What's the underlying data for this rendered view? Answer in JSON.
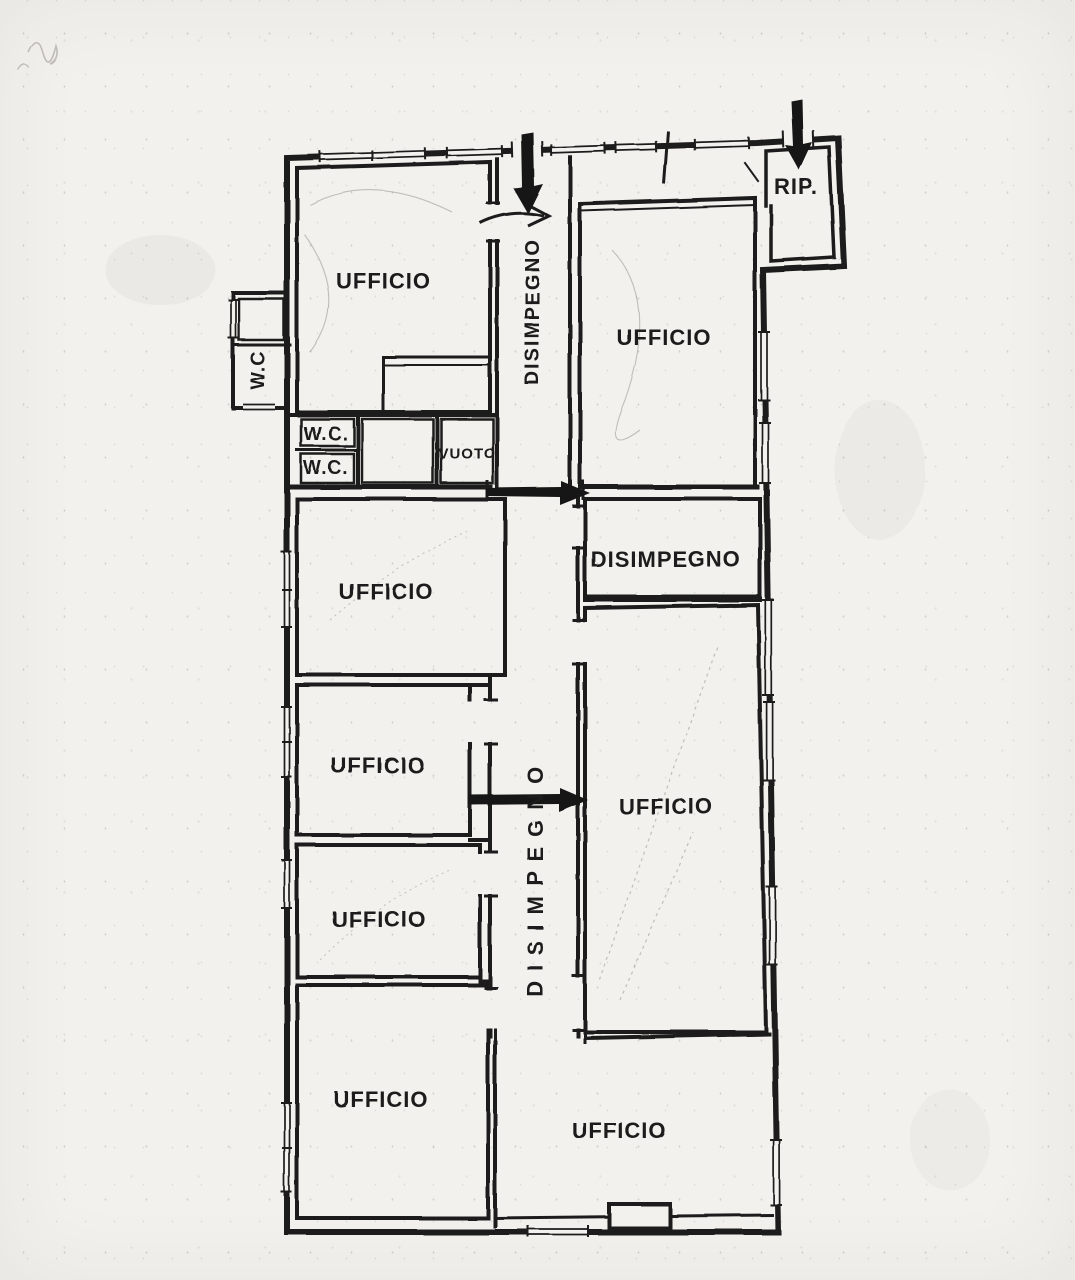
{
  "page": {
    "kind": "scanned floor plan",
    "paper_color": "#f2f1ed",
    "ink_color": "#1c1c1c"
  },
  "floor_plan": {
    "labels": [
      {
        "name": "ufficio-top-left",
        "text": "UFFICIO"
      },
      {
        "name": "disimpegno-top",
        "text": "DISIMPEGNO"
      },
      {
        "name": "ufficio-top-right",
        "text": "UFFICIO"
      },
      {
        "name": "ripostiglio",
        "text": "RIP."
      },
      {
        "name": "wc-external",
        "text": "W.C"
      },
      {
        "name": "wc-upper",
        "text": "W.C."
      },
      {
        "name": "wc-lower",
        "text": "W.C."
      },
      {
        "name": "vuoto",
        "text": "VUOTO"
      },
      {
        "name": "ufficio-mid-left-1",
        "text": "UFFICIO"
      },
      {
        "name": "disimpegno-right",
        "text": "DISIMPEGNO"
      },
      {
        "name": "ufficio-mid-left-2",
        "text": "UFFICIO"
      },
      {
        "name": "disimpegno-central",
        "text": "DISIMPEGNO"
      },
      {
        "name": "ufficio-mid-right",
        "text": "UFFICIO"
      },
      {
        "name": "ufficio-mid-left-3",
        "text": "UFFICIO"
      },
      {
        "name": "ufficio-bottom-left",
        "text": "UFFICIO"
      },
      {
        "name": "ufficio-bottom-right",
        "text": "UFFICIO"
      }
    ],
    "icons": {
      "entrance-arrow-main": "thick down arrow",
      "entrance-arrow-rip": "thick down arrow",
      "door-arrow-top": "hand-drawn right arrow",
      "passage-arrow-upper": "thick right arrow",
      "passage-arrow-lower": "thick right arrow"
    }
  }
}
